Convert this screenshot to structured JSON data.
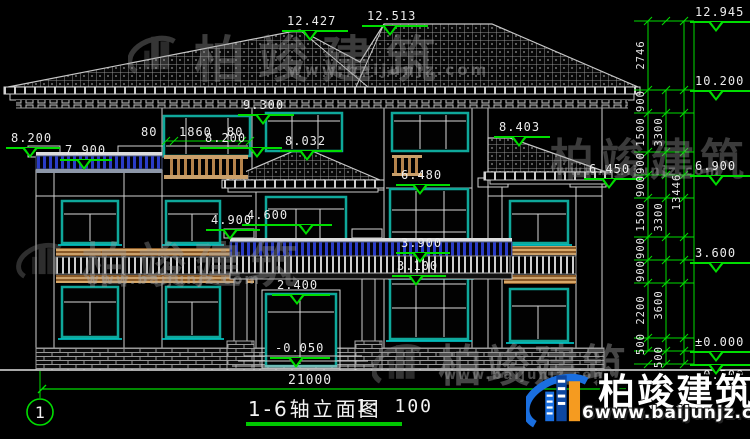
{
  "title_block": {
    "axis_label": "1",
    "drawing_title": "1-6轴立面图",
    "scale": "1: 100"
  },
  "dimensions": {
    "total_width": "21000",
    "window_top": [
      "80",
      "1860",
      "80"
    ],
    "right_chain": {
      "col_inner": [
        "2746",
        "900",
        "1500",
        "900",
        "900",
        "1500",
        "900",
        "900",
        "2200",
        "500"
      ],
      "col_mid": [
        "3300",
        "3300",
        "3600",
        "500"
      ],
      "col_total": "13446"
    }
  },
  "elevation_markers": [
    {
      "id": "ridge-left",
      "value": "12.427"
    },
    {
      "id": "ridge-right",
      "value": "12.513"
    },
    {
      "id": "ridge-top",
      "value": "12.945"
    },
    {
      "id": "right-eave",
      "value": "10.200"
    },
    {
      "id": "center-window-top",
      "value": "9.300"
    },
    {
      "id": "left-parapet",
      "value": "8.200"
    },
    {
      "id": "terrace-floor",
      "value": "7.900"
    },
    {
      "id": "center-parapet",
      "value": "8.200"
    },
    {
      "id": "porch-roof-ridge",
      "value": "8.032"
    },
    {
      "id": "right-wing-roof",
      "value": "8.403"
    },
    {
      "id": "level-6900",
      "value": "6.900"
    },
    {
      "id": "porch-eave",
      "value": "6.480"
    },
    {
      "id": "right-wing-eave",
      "value": "6.450"
    },
    {
      "id": "balcony-rail-top",
      "value": "4.900"
    },
    {
      "id": "window-sill-4600",
      "value": "4.600"
    },
    {
      "id": "level-3900",
      "value": "3.900"
    },
    {
      "id": "level-3100",
      "value": "3.100"
    },
    {
      "id": "level-3600",
      "value": "3.600"
    },
    {
      "id": "door-top",
      "value": "2.400"
    },
    {
      "id": "ground-zero",
      "value": "±0.000"
    },
    {
      "id": "entry-level",
      "value": "-0.050"
    },
    {
      "id": "plinth-bottom",
      "value": "-0.500"
    }
  ],
  "watermark": {
    "brand": "柏竣建筑",
    "url": "www.baijunjz.com"
  },
  "footer_logo": {
    "brand": "柏竣建筑",
    "url": "6www.baijunjz.com"
  },
  "colors": {
    "dim_green": "#00dd00",
    "window_teal": "#0fa89b",
    "sill_cyan": "#00dcdc",
    "railing_blue": "#2a3cc8",
    "wood_tan": "#c09158",
    "line_white": "#cfcfcf",
    "logo_blue": "#1a6fe0",
    "logo_orange": "#f59b20"
  }
}
